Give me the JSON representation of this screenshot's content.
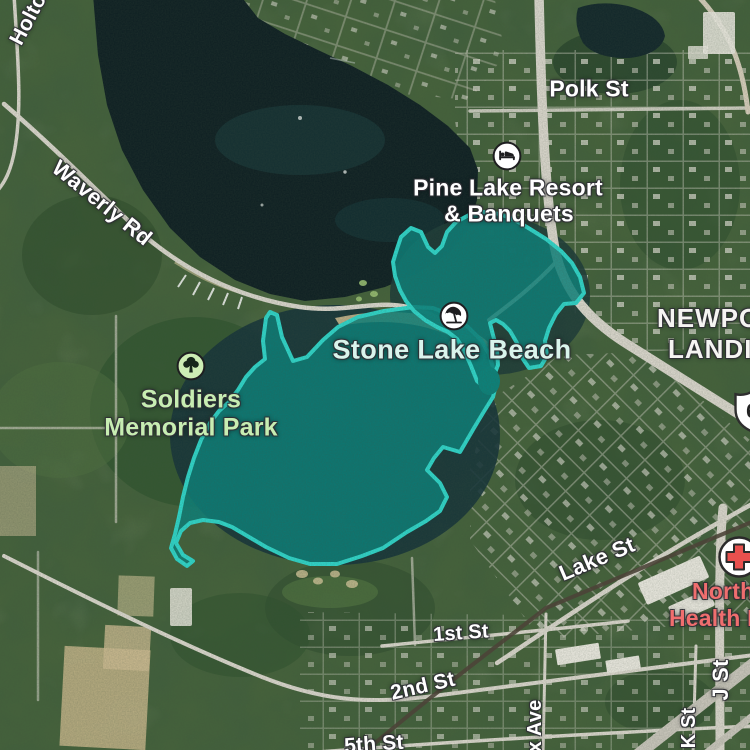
{
  "map_type": "satellite",
  "colors": {
    "highlight_stroke": "#2fd8cc",
    "highlight_fill": "#0b837c",
    "deep_water": "#0f2023",
    "terrain_green": "#46633b",
    "road": "#ddd9cf",
    "railroad": "#4e4337",
    "sand": "#cdbb8f",
    "street_label": "#ffffff",
    "beach_label_color": "#d9f4ec",
    "park_label_color": "#c7edb2",
    "hospital_label_color": "#ef6e6e"
  },
  "pois": {
    "resort": {
      "icon": "bed-icon",
      "line1": "Pine Lake Resort",
      "line2": "& Banquets"
    },
    "beach": {
      "icon": "beach-umbrella-icon",
      "label": "Stone Lake Beach"
    },
    "park": {
      "icon": "tree-icon",
      "line1": "Soldiers",
      "line2": "Memorial Park"
    },
    "hospital": {
      "icon": "hospital-cross-icon",
      "line1": "Northwest",
      "line2": "Health La"
    }
  },
  "streets": {
    "holton": "Holton",
    "waverly": "Waverly Rd",
    "polk": "Polk St",
    "lake": "Lake St",
    "first": "1st St",
    "second": "2nd St",
    "fifth": "5th St",
    "ave_fragment": "x Ave",
    "k": "K St",
    "j": "J St"
  },
  "places": {
    "newport_line1": "NEWPORT",
    "newport_line2": "LANDING"
  },
  "route_shield": {
    "number": "6"
  }
}
